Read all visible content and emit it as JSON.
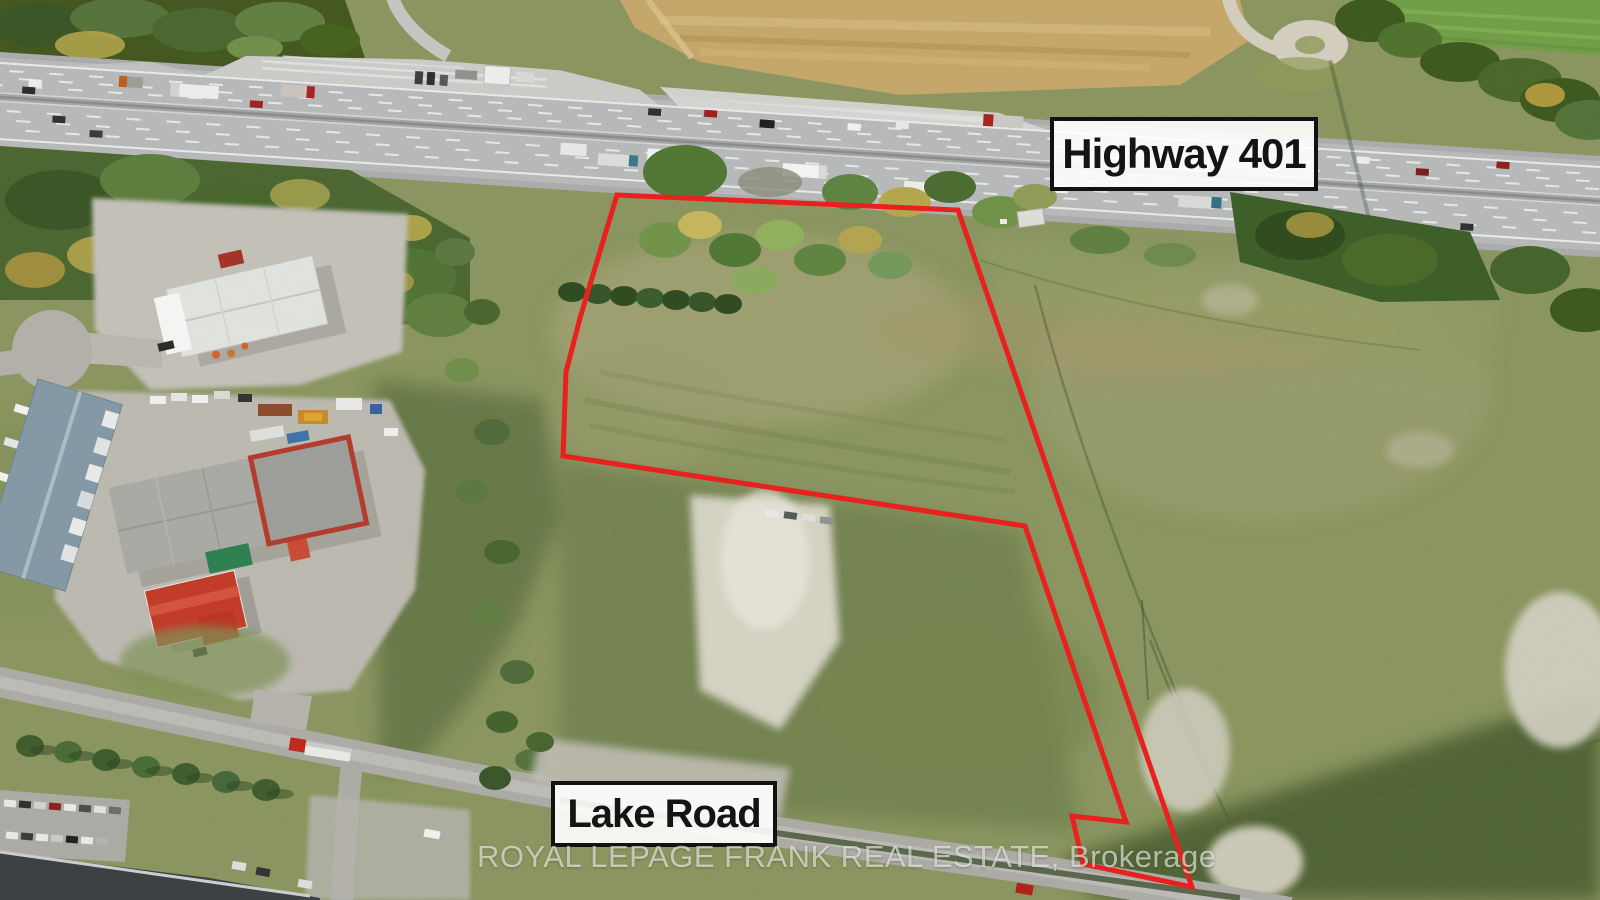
{
  "labels": {
    "highway": "Highway 401",
    "road": "Lake Road"
  },
  "watermark": "ROYAL LEPAGE FRANK REAL ESTATE, Brokerage",
  "property_outline": {
    "stroke_color": "#e8211f",
    "stroke_width": "5",
    "points": "617,195 958,210 1192,887 1083,864 1072,816 1126,822 1025,526 563,456 566,372 580,318 598,258"
  },
  "palette": {
    "field_base": "#87925e",
    "highway_pavement": "#b5b7b8",
    "tan_field": "#c4a468",
    "dark_trees": "#3a5426",
    "label_border": "#121212",
    "label_background": "rgba(255,255,255,0.9)",
    "watermark_color": "rgba(247,247,245,0.62)"
  }
}
